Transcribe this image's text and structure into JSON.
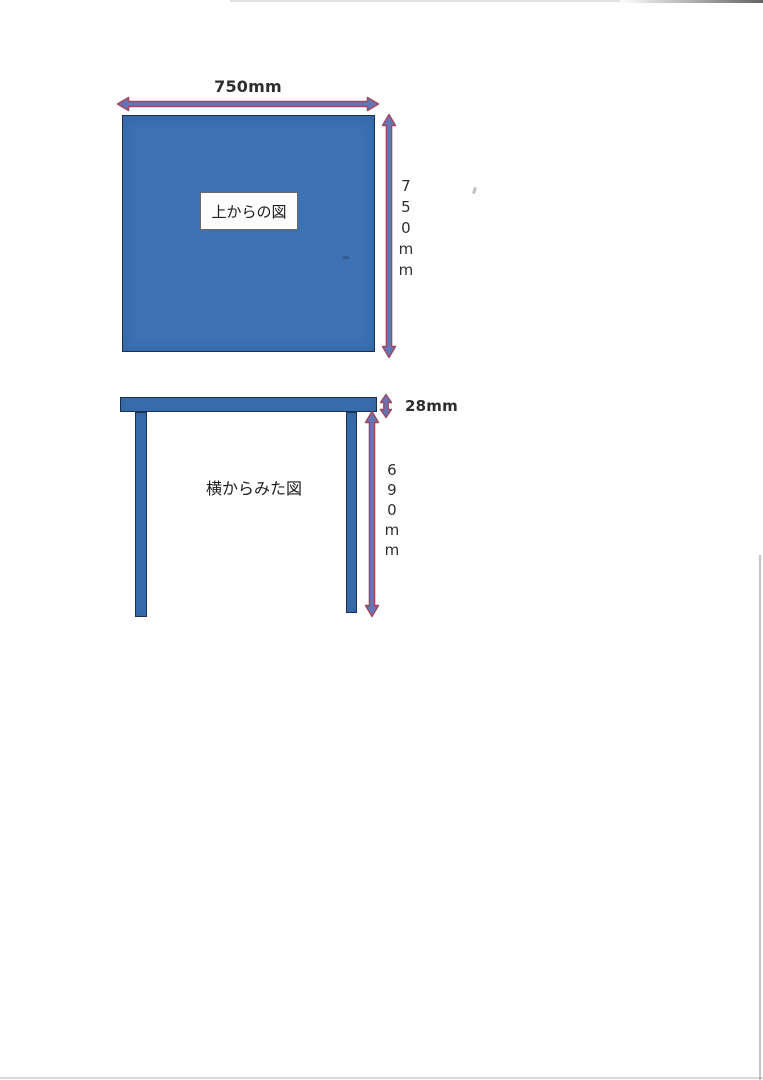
{
  "colors": {
    "paper": "#ffffff",
    "shape_fill": "#3b72b4",
    "shape_border": "#1b2f52",
    "arrow_fill": "#6673b5",
    "arrow_stroke": "#a1455e",
    "text": "#262626"
  },
  "top_view": {
    "caption": "上からの図",
    "width_label": "750mm",
    "height_label": "750mm",
    "height_label_stacked": "7\n5\n0\nm\nm"
  },
  "side_view": {
    "caption": "横からみた図",
    "top_thickness_label": "28mm",
    "leg_height_label": "690mm",
    "leg_height_label_stacked": "6\n9\n0\nm\nm"
  }
}
